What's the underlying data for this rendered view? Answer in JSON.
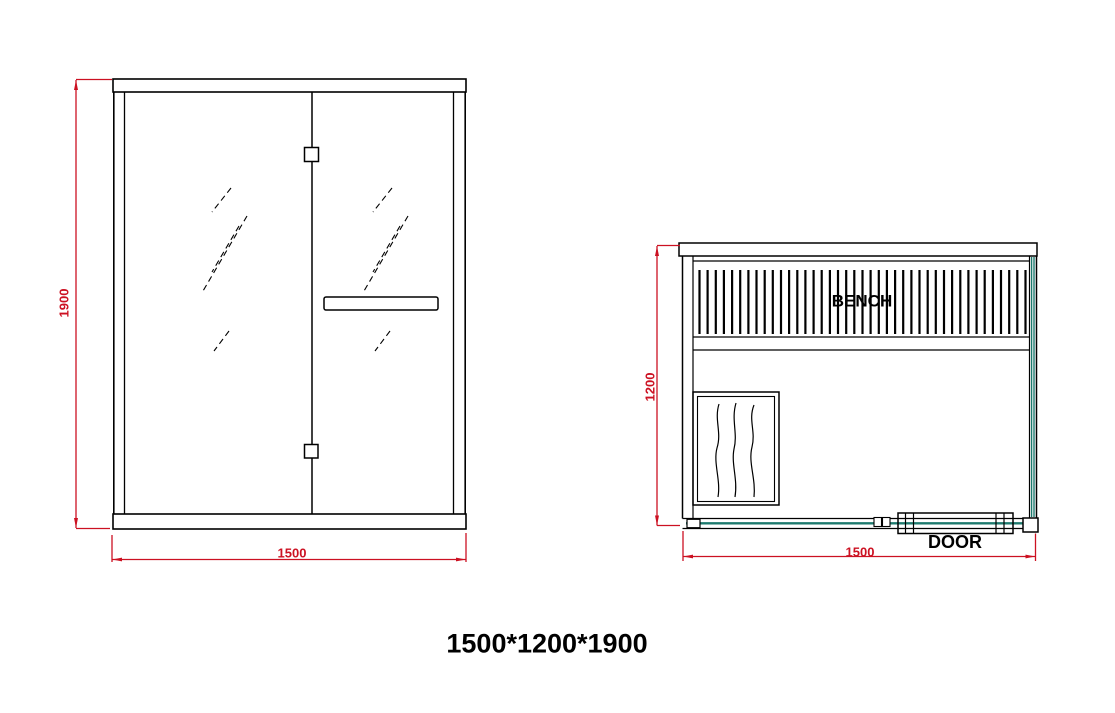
{
  "drawing": {
    "title": "1500*1200*1900",
    "front_view": {
      "height_dim": "1900",
      "width_dim": "1500"
    },
    "plan_view": {
      "depth_dim": "1200",
      "width_dim": "1500",
      "bench_label": "BENCH",
      "door_label": "DOOR"
    },
    "colors": {
      "dimension_red": "#cc1122",
      "glass_teal": "#1d7a6e",
      "line_black": "#000000"
    }
  }
}
